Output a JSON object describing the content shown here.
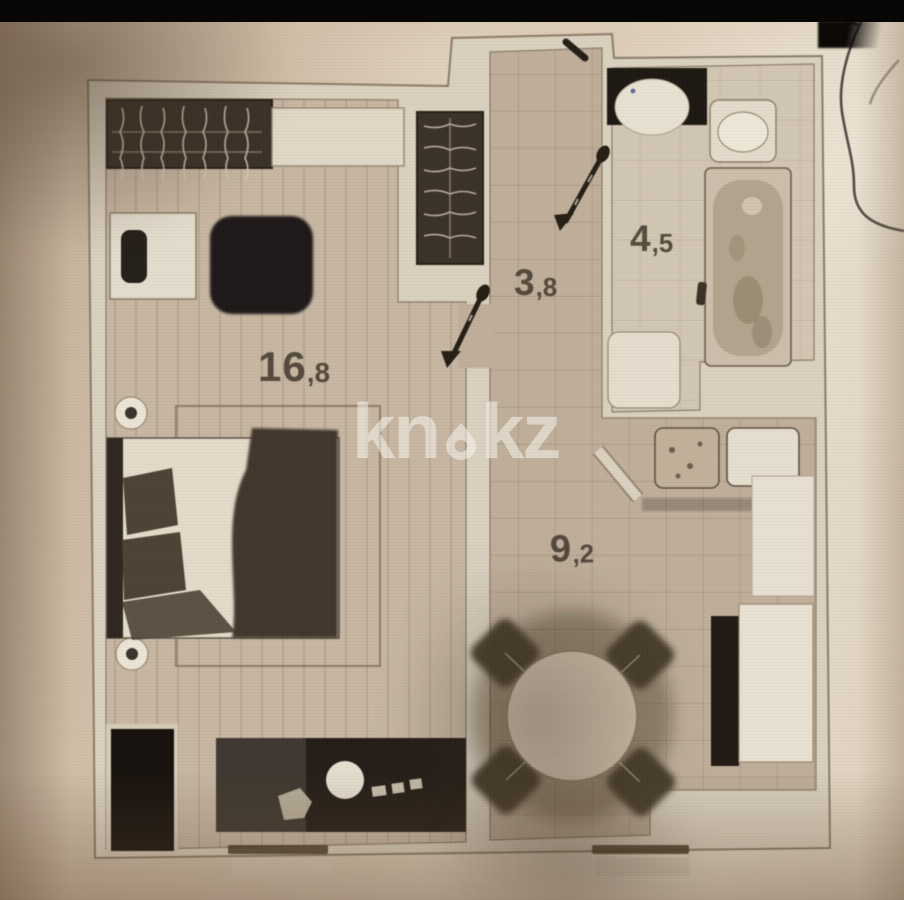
{
  "image_kind": "photographed apartment floor plan",
  "top_bar_color": "#070605",
  "paper_color": "#d8c7b2",
  "watermark": {
    "part1": "kn",
    "part2": "kz",
    "icon": "house-icon",
    "color": "rgba(252,249,242,0.52)"
  },
  "floor_plan": {
    "rooms": {
      "living": {
        "name": "living-room",
        "area": "16,8",
        "area_main": "16",
        "area_sub": ",8"
      },
      "hall": {
        "name": "hallway",
        "area": "3,8",
        "area_main": "3",
        "area_sub": ",8"
      },
      "bath": {
        "name": "bathroom",
        "area": "4,5",
        "area_main": "4",
        "area_sub": ",5"
      },
      "kitchen": {
        "name": "kitchen",
        "area": "9,2",
        "area_main": "9",
        "area_sub": ",2"
      }
    },
    "elements": [
      "wardrobe-hatched",
      "shelf-cabinet",
      "desk",
      "desk-chair",
      "armchair",
      "wall-lamp",
      "bed",
      "rug",
      "tv-console",
      "sink-circle",
      "hob-marks",
      "low-wardrobe",
      "window-sill",
      "hall-closet-hatched",
      "pen-arrow",
      "entrance-door-mark",
      "washing-machine",
      "wash-basin",
      "toilet",
      "bathtub",
      "tub-faucet",
      "bath-cabinet",
      "kitchen-unit",
      "fridge-unit",
      "vent-shaft",
      "counter",
      "dining-table",
      "dining-chair",
      "cable-wire"
    ],
    "colors": {
      "wall": "#ddd2bf",
      "wall_edge": "#8d7c64",
      "floor_living": "#c9b8a1",
      "floor_tiles": "#c2b099",
      "floor_bath": "#d5c8b3",
      "furniture_dark": "#1d1712",
      "ink_pen": "#241c12",
      "label_text": "#44392c"
    }
  }
}
